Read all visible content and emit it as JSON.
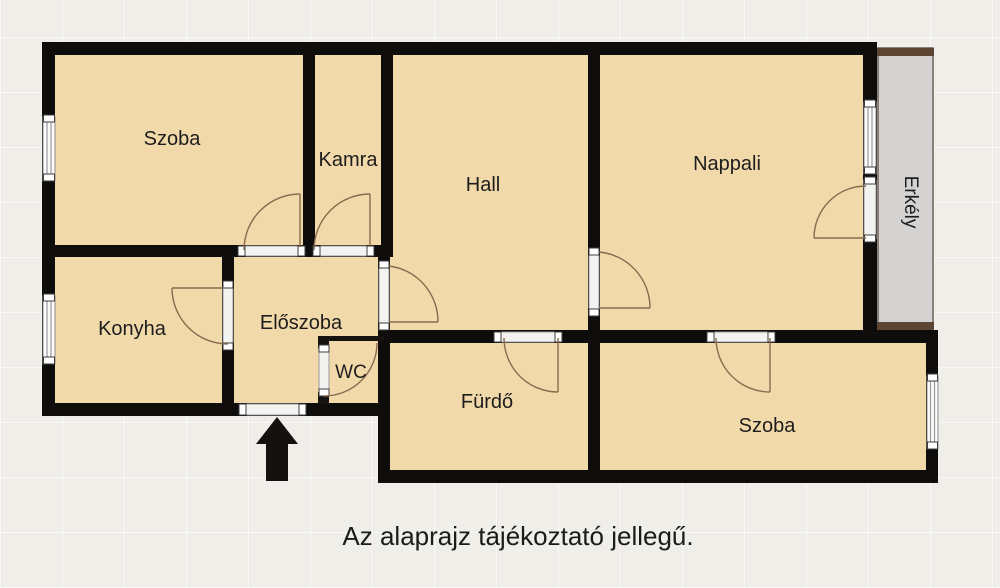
{
  "plan": {
    "caption": "Az alaprajz tájékoztató jellegű.",
    "rooms": [
      {
        "id": "szoba-1",
        "label": "Szoba"
      },
      {
        "id": "kamra",
        "label": "Kamra"
      },
      {
        "id": "hall",
        "label": "Hall"
      },
      {
        "id": "nappali",
        "label": "Nappali"
      },
      {
        "id": "erkely",
        "label": "Erkély"
      },
      {
        "id": "konyha",
        "label": "Konyha"
      },
      {
        "id": "eloszoba",
        "label": "Előszoba"
      },
      {
        "id": "wc",
        "label": "WC"
      },
      {
        "id": "furdo",
        "label": "Fürdő"
      },
      {
        "id": "szoba-2",
        "label": "Szoba"
      }
    ],
    "colors": {
      "room_fill": "#f2d9aa",
      "wall": "#0f0d0b",
      "balcony_fill": "#d5d3d1",
      "balcony_trim": "#5d4534",
      "door_arc": "#8a6a4f",
      "background": "#f0eee9",
      "text": "#1d1d1d"
    }
  }
}
